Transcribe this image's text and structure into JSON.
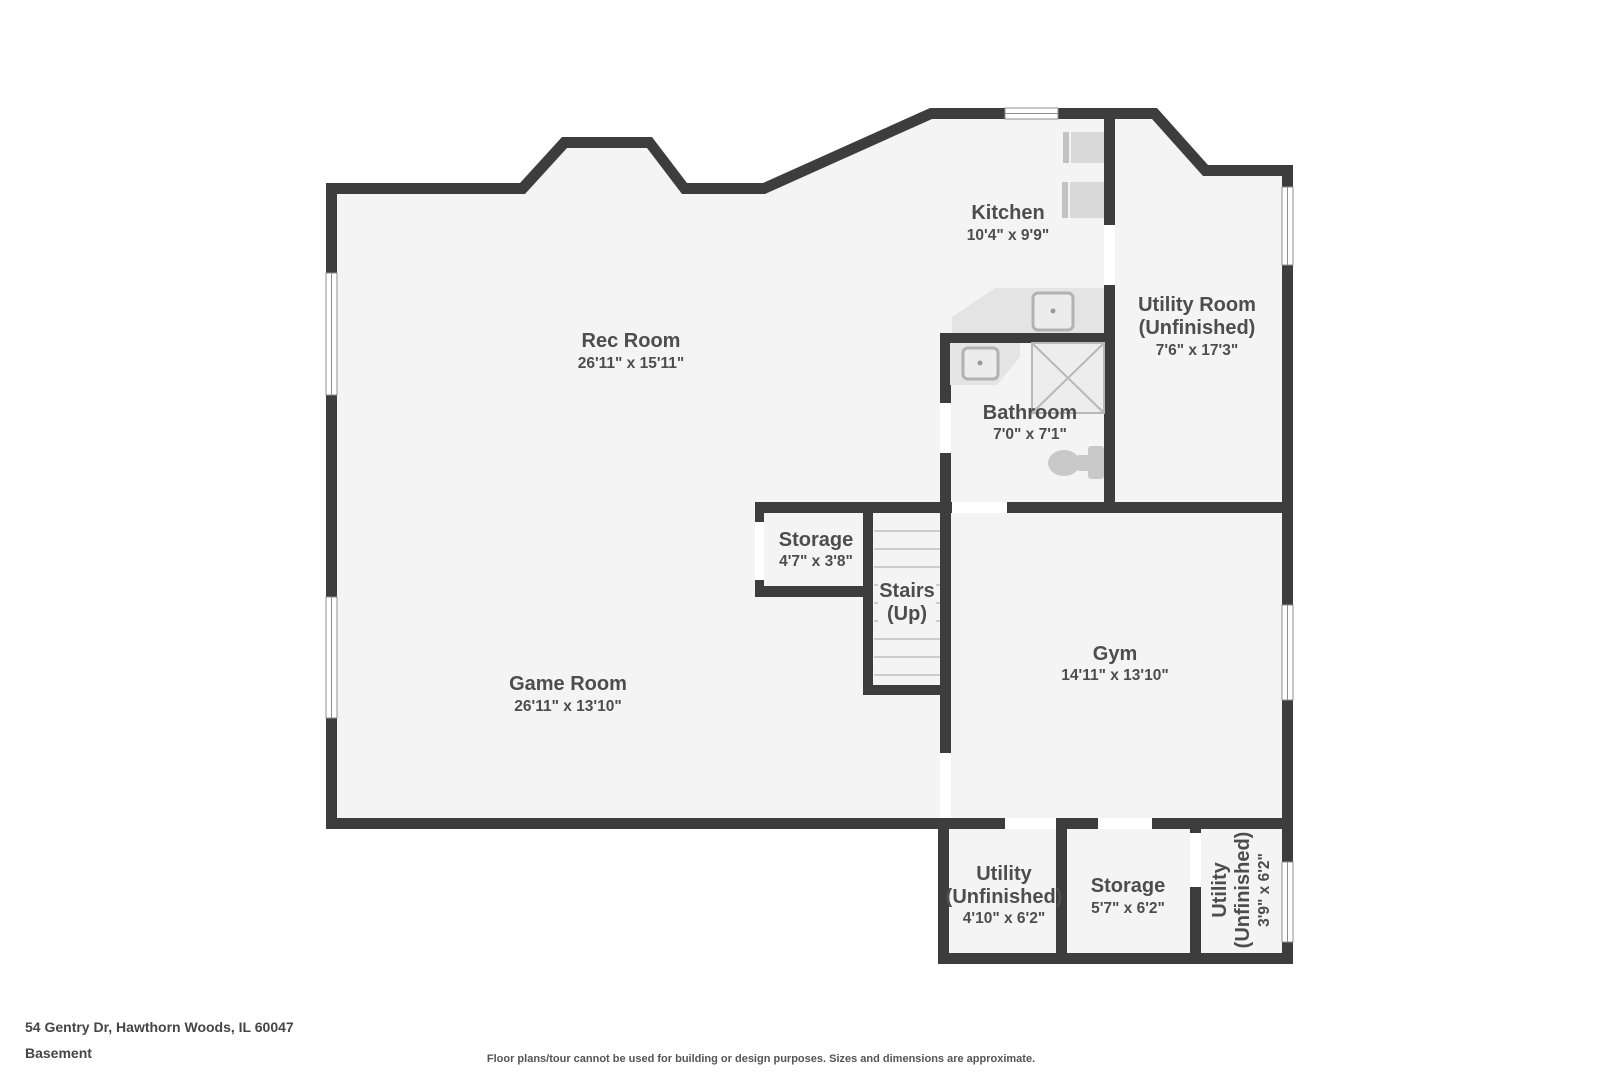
{
  "page": {
    "footer": {
      "address": "54 Gentry Dr, Hawthorn Woods, IL 60047",
      "level": "Basement",
      "disclaimer": "Floor plans/tour cannot be used for building or design purposes. Sizes and dimensions are approximate."
    },
    "rooms": {
      "rec_room": {
        "name": "Rec Room",
        "dims": "26'11\" x 15'11\""
      },
      "kitchen": {
        "name": "Kitchen",
        "dims": "10'4\" x 9'9\""
      },
      "utility_room": {
        "name": "Utility Room",
        "qualifier": "(Unfinished)",
        "dims": "7'6\" x 17'3\""
      },
      "bathroom": {
        "name": "Bathroom",
        "dims": "7'0\" x 7'1\""
      },
      "storage": {
        "name": "Storage",
        "dims": "4'7\" x 3'8\""
      },
      "stairs": {
        "name": "Stairs",
        "qualifier": "(Up)"
      },
      "gym": {
        "name": "Gym",
        "dims": "14'11\" x 13'10\""
      },
      "game_room": {
        "name": "Game Room",
        "dims": "26'11\" x 13'10\""
      },
      "utility_a": {
        "name": "Utility",
        "qualifier": "(Unfinished)",
        "dims": "4'10\" x 6'2\""
      },
      "storage_b": {
        "name": "Storage",
        "dims": "5'7\" x 6'2\""
      },
      "utility_b": {
        "name": "Utility",
        "qualifier": "(Unfinished)",
        "dims": "3'9\" x 6'2\""
      }
    },
    "colors": {
      "wall": "#3d3d3d",
      "floor": "#f4f4f4",
      "fixture": "#e4e4e4",
      "label_text": "#4d4d4d"
    }
  }
}
